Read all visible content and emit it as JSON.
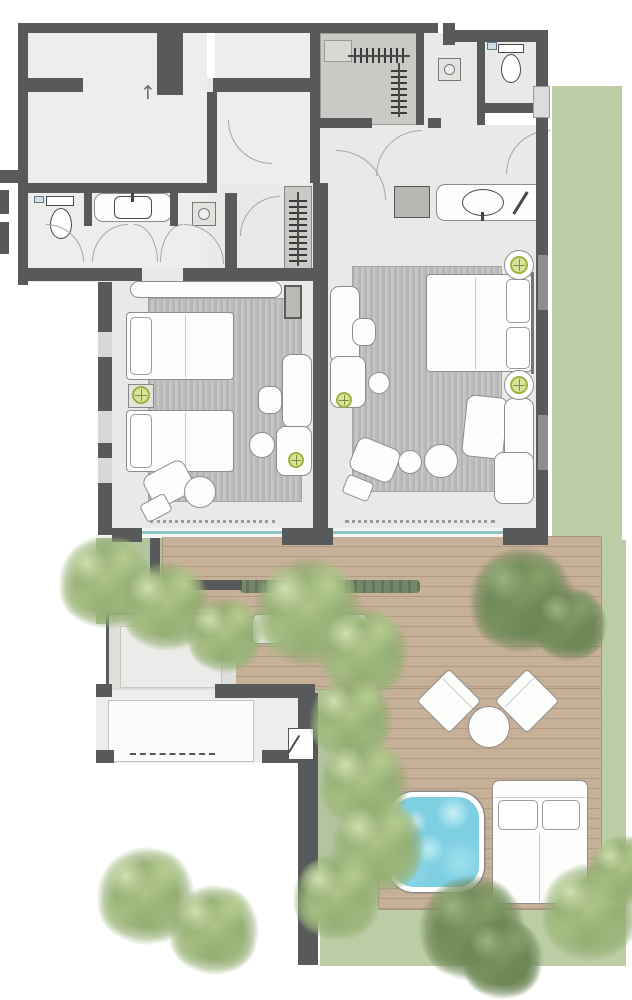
{
  "plan": {
    "kind": "architectural floor plan, top-down render of a two-bedroom resort suite with private terrace",
    "rooms": [
      {
        "name": "adjacent-unit-north",
        "furniture": []
      },
      {
        "name": "connecting-room",
        "furniture": []
      },
      {
        "name": "walk-in-closet",
        "fixtures": [
          "hanging-rail",
          "hanging-rail",
          "luggage-bench"
        ]
      },
      {
        "name": "shower-room-north",
        "fixtures": [
          "walk-in-shower-drain"
        ]
      },
      {
        "name": "wc-north",
        "fixtures": [
          "wall-hung-toilet",
          "hand-basin"
        ]
      },
      {
        "name": "bathroom-west",
        "fixtures": [
          "toilet",
          "vanity-sink",
          "walk-in-shower-drain",
          "double-swing-doors"
        ]
      },
      {
        "name": "hallway",
        "fixtures": [
          "vanity-counter-oval-sink",
          "storage-cube",
          "door-swings"
        ]
      },
      {
        "name": "twin-bedroom",
        "furniture": [
          "twin-bed",
          "twin-bed",
          "nightstand",
          "table-lamp",
          "table-lamp",
          "headboard-bench",
          "desk",
          "desk-chair",
          "console",
          "side-table-round",
          "side-table-round",
          "lounge-chair",
          "ottoman",
          "area-rug",
          "wardrobe",
          "tv-panel"
        ]
      },
      {
        "name": "master-bedroom",
        "furniture": [
          "double-bed",
          "table-lamp",
          "table-lamp",
          "table-lamp",
          "desk",
          "desk-chair",
          "console",
          "round-stool",
          "lounge-chair",
          "ottoman",
          "side-table-round",
          "side-table-round",
          "corner-sofa",
          "area-rug"
        ]
      }
    ],
    "outdoor": {
      "terrace_deck": [
        "armchair",
        "armchair",
        "coffee-table-round",
        "sun-lounger",
        "sun-lounger",
        "side-table-round",
        "plunge-pool",
        "daybed"
      ],
      "garden": [
        "lawn-east",
        "lawn-south",
        "palm-trees",
        "hedge",
        "private-patio"
      ],
      "tree_count": 17
    },
    "counts": {
      "bedrooms": 2,
      "bathrooms": 3,
      "beds": 4,
      "pools": 1
    }
  },
  "symbols": {
    "entry_arrow": "↑"
  },
  "palette": {
    "wall": "#57595a",
    "floor": "#e9e9e7",
    "closet": "#c9c9c6",
    "rug_a": "#b5b6b4",
    "rug_b": "#c7c8c6",
    "deck_a": "#c7b098",
    "deck_b": "#b09a83",
    "grass": "#bccda6",
    "garden": "#b3c59e",
    "hedge": "#75876b",
    "pool": "#7fcfe3",
    "pool_light": "#c9f2f6",
    "patio": "#dededb",
    "glass": "#8fc6c1",
    "line": "#8e8e8c",
    "lamp": "#d9e49a",
    "lamp_ring": "#9ab33f"
  }
}
